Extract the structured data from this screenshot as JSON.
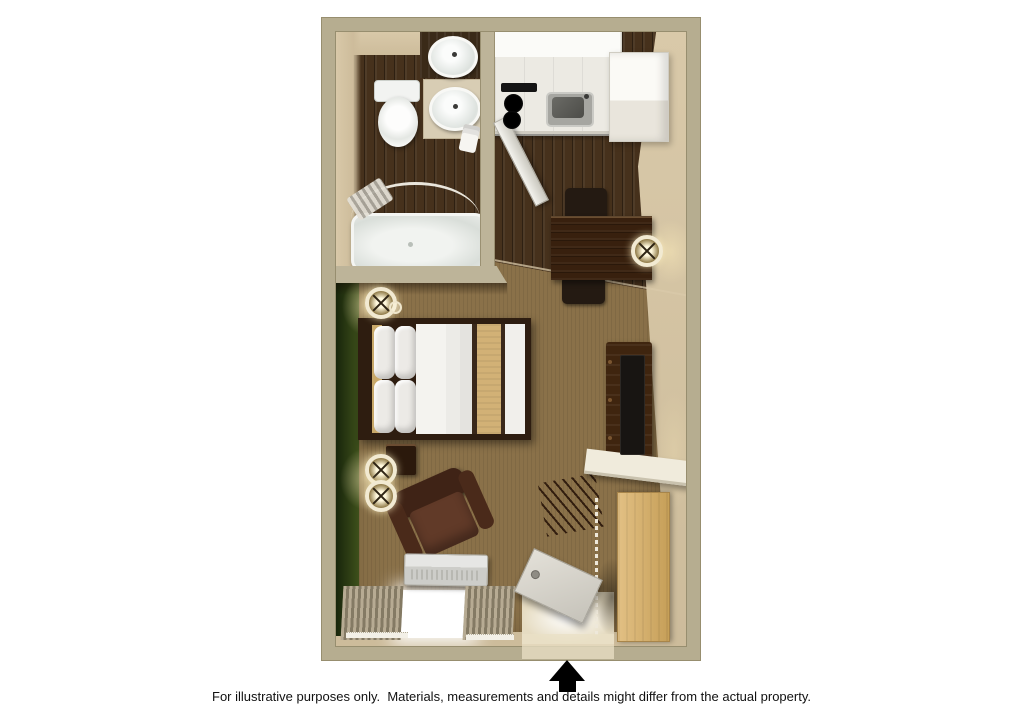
{
  "footer": {
    "disclaimer": "For illustrative purposes only.  Materials, measurements and details might differ from the actual property."
  },
  "entrance_arrow": {
    "direction": "up",
    "meaning": "entrance"
  },
  "floor_plan": {
    "view": "3d-top-down-studio-floorplan",
    "rooms": [
      "bathroom",
      "kitchen",
      "dining-area",
      "sleeping-area",
      "living-area",
      "closet",
      "entry"
    ],
    "bathroom_items": [
      "toilet",
      "double-sink-vanity",
      "bathtub",
      "shower-rod",
      "shower-curtain",
      "towel",
      "bathroom-door"
    ],
    "kitchen_items": [
      "upper-cabinets",
      "countertop",
      "stove-burners",
      "kitchen-sink",
      "refrigerator"
    ],
    "dining_items": [
      "dining-table",
      "dining-chair",
      "dining-chair"
    ],
    "sleeping_items": [
      "bed",
      "pillows",
      "headboard",
      "nightstand",
      "wall-sconce"
    ],
    "living_items": [
      "armchair",
      "tv-console",
      "tv",
      "ac-unit",
      "window",
      "curtains"
    ],
    "closet_items": [
      "shelf-counter",
      "hangers",
      "closet-rod",
      "closet-sliding-door"
    ],
    "entry_items": [
      "entry-door",
      "doorway"
    ]
  },
  "palette": {
    "pageBg": "#ffffff",
    "wall": "#b6ad90",
    "wallEdge": "#978e6f",
    "wallInnerCol": "#bdb499",
    "wallFace": "#cdbc9b",
    "wallFaceLight": "#d9c9a9",
    "carpet": "#8a7149",
    "wood": "#46311c",
    "green1": "#16230a",
    "green2": "#3e501b",
    "bedTan": "#d2b176",
    "curtain1": "#b7ab93",
    "curtain2": "#847a64",
    "text": "#111111"
  }
}
